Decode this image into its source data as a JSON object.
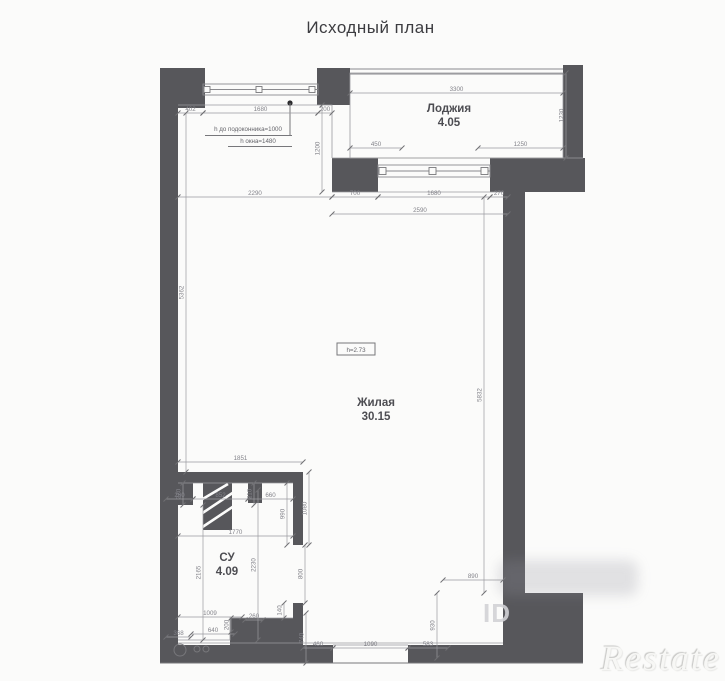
{
  "title": "Исходный план",
  "watermarks": {
    "id": "ID",
    "brand": "Restate"
  },
  "colors": {
    "wall": "#57575b",
    "background": "#fbfbfa",
    "dim_text": "#83838a",
    "label_text": "#4d4d52"
  },
  "plan": {
    "rooms": [
      {
        "name": "Лоджия",
        "area": "4.05",
        "x": 449,
        "y": 112
      },
      {
        "name": "Жилая",
        "area": "30.15",
        "x": 376,
        "y": 406
      },
      {
        "name": "СУ",
        "area": "4.09",
        "x": 227,
        "y": 561
      }
    ],
    "ceiling_note": {
      "text": "h=2.73",
      "x": 356,
      "y": 352
    },
    "window_notes": [
      {
        "text": "h до подоконника=1000",
        "x": 248,
        "y": 131
      },
      {
        "text": "h окна=1480",
        "x": 258,
        "y": 143
      }
    ],
    "dimensions": [
      {
        "value": "402",
        "y": 113,
        "x1": 178,
        "x2": 203
      },
      {
        "value": "1680",
        "y": 113,
        "x1": 203,
        "x2": 318
      },
      {
        "value": "200",
        "y": 113,
        "x1": 318,
        "x2": 332
      },
      {
        "value": "3300",
        "y": 93,
        "x1": 350,
        "x2": 563
      },
      {
        "value": "450",
        "y": 148,
        "x1": 350,
        "x2": 402
      },
      {
        "value": "1250",
        "y": 148,
        "x1": 478,
        "x2": 563
      },
      {
        "value": "2290",
        "y": 197,
        "x1": 178,
        "x2": 332
      },
      {
        "value": "700",
        "y": 197,
        "x1": 332,
        "x2": 378
      },
      {
        "value": "1680",
        "y": 197,
        "x1": 378,
        "x2": 490
      },
      {
        "value": "270",
        "y": 197,
        "x1": 490,
        "x2": 508
      },
      {
        "value": "2590",
        "y": 214,
        "x1": 332,
        "x2": 508
      },
      {
        "value": "1851",
        "y": 462,
        "x1": 178,
        "x2": 303
      },
      {
        "value": "260",
        "y": 499,
        "x1": 166,
        "x2": 193
      },
      {
        "value": "852",
        "y": 499,
        "x1": 193,
        "x2": 248
      },
      {
        "value": "660",
        "y": 499,
        "x1": 248,
        "x2": 293
      },
      {
        "value": "1770",
        "y": 536,
        "x1": 178,
        "x2": 293
      },
      {
        "value": "1009",
        "y": 617,
        "x1": 178,
        "x2": 242
      },
      {
        "value": "260",
        "y": 620,
        "x1": 245,
        "x2": 263
      },
      {
        "value": "368",
        "y": 637,
        "x1": 166,
        "x2": 191
      },
      {
        "value": "640",
        "y": 634,
        "x1": 191,
        "x2": 235
      },
      {
        "value": "460",
        "y": 648,
        "x1": 303,
        "x2": 333
      },
      {
        "value": "1090",
        "y": 648,
        "x1": 333,
        "x2": 408
      },
      {
        "value": "583",
        "y": 648,
        "x1": 408,
        "x2": 448
      },
      {
        "value": "890",
        "y": 580,
        "x1": 443,
        "x2": 503
      },
      {
        "value": "1200",
        "x": 322,
        "y1": 105,
        "y2": 192
      },
      {
        "value": "1230",
        "x": 566,
        "y1": 73,
        "y2": 158
      },
      {
        "value": "5362",
        "x": 186,
        "y1": 113,
        "y2": 472
      },
      {
        "value": "5832",
        "x": 484,
        "y1": 197,
        "y2": 593
      },
      {
        "value": "220",
        "x": 183,
        "y1": 483,
        "y2": 505
      },
      {
        "value": "210",
        "x": 254,
        "y1": 483,
        "y2": 505
      },
      {
        "value": "990",
        "x": 287,
        "y1": 483,
        "y2": 545
      },
      {
        "value": "1080",
        "x": 309,
        "y1": 472,
        "y2": 545
      },
      {
        "value": "2230",
        "x": 258,
        "y1": 490,
        "y2": 640
      },
      {
        "value": "2165",
        "x": 203,
        "y1": 505,
        "y2": 640
      },
      {
        "value": "800",
        "x": 305,
        "y1": 545,
        "y2": 603
      },
      {
        "value": "140",
        "x": 284,
        "y1": 603,
        "y2": 618
      },
      {
        "value": "200",
        "x": 231,
        "y1": 618,
        "y2": 632
      },
      {
        "value": "740",
        "x": 306,
        "y1": 613,
        "y2": 663
      },
      {
        "value": "930",
        "x": 437,
        "y1": 593,
        "y2": 658
      }
    ]
  }
}
